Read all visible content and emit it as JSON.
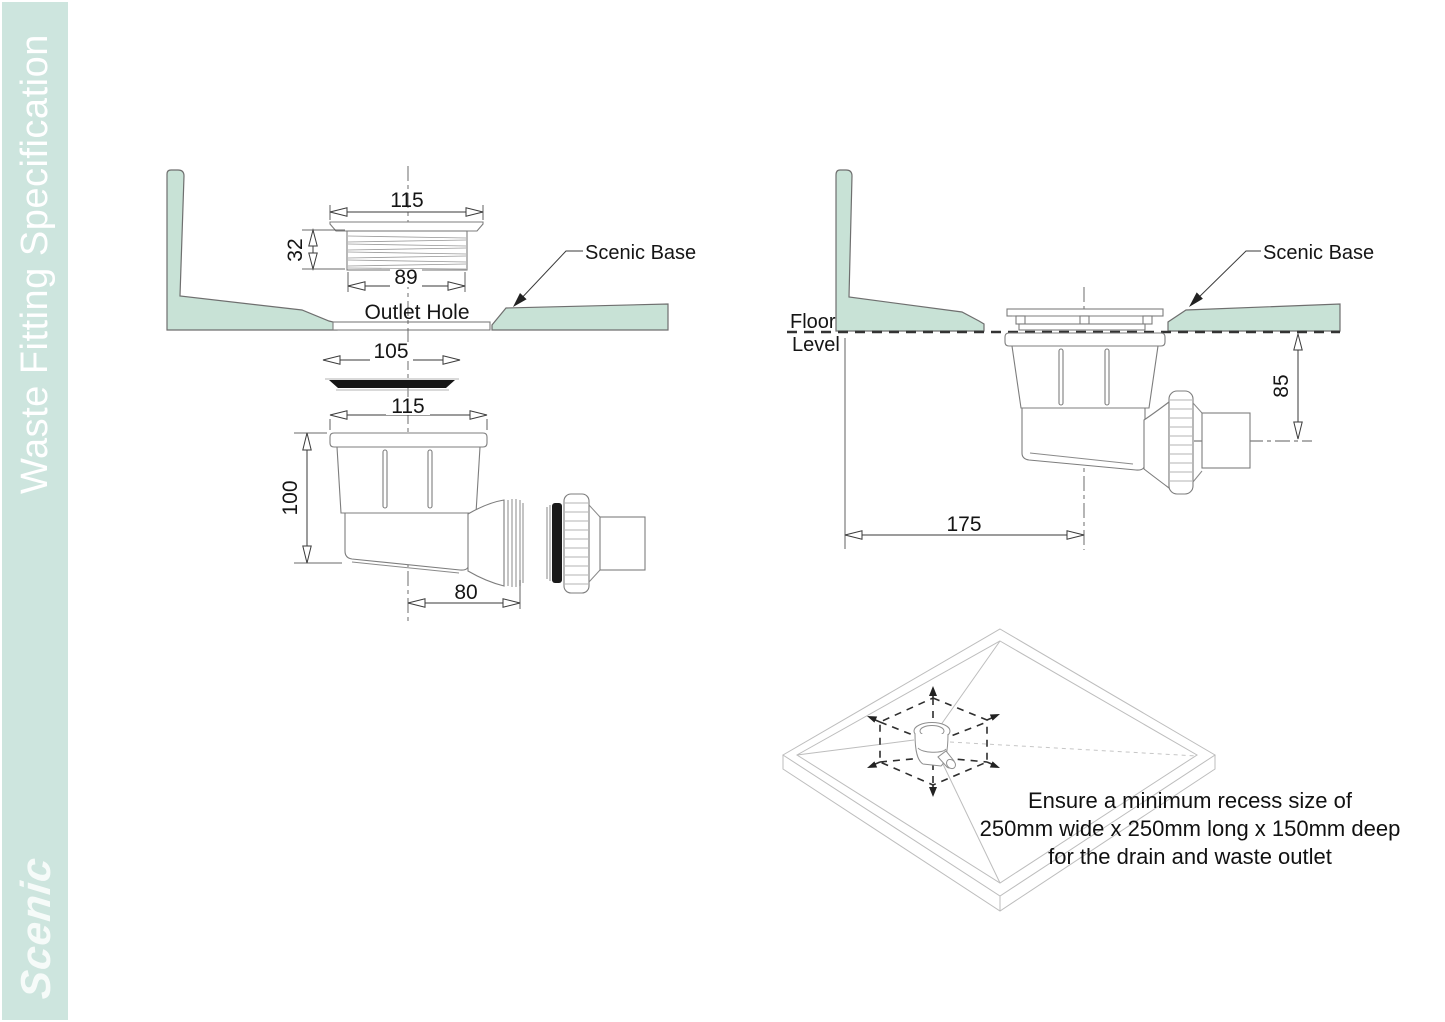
{
  "sidebar": {
    "title": "Waste Fitting Specification",
    "brand": "Scenic"
  },
  "labels": {
    "scenic_base": "Scenic Base",
    "outlet_hole": "Outlet Hole",
    "floor_line1": "Floor",
    "floor_line2": "Level"
  },
  "dimensions": {
    "left": {
      "flange_width": "115",
      "thread_height": "32",
      "thread_width": "89",
      "seal_width": "105",
      "trap_width": "115",
      "trap_height": "100",
      "outlet_offset": "80"
    },
    "right": {
      "outlet_depth": "85",
      "wall_offset": "175"
    }
  },
  "note": {
    "line1": "Ensure a minimum recess size of",
    "line2": "250mm wide x 250mm long x 150mm deep",
    "line3": "for the drain and waste outlet"
  },
  "colors": {
    "sidebar_bg": "#cde5de",
    "base_fill": "#c8e2d6",
    "line_dark": "#2f2f2f",
    "line_light": "#8a8a8a"
  }
}
